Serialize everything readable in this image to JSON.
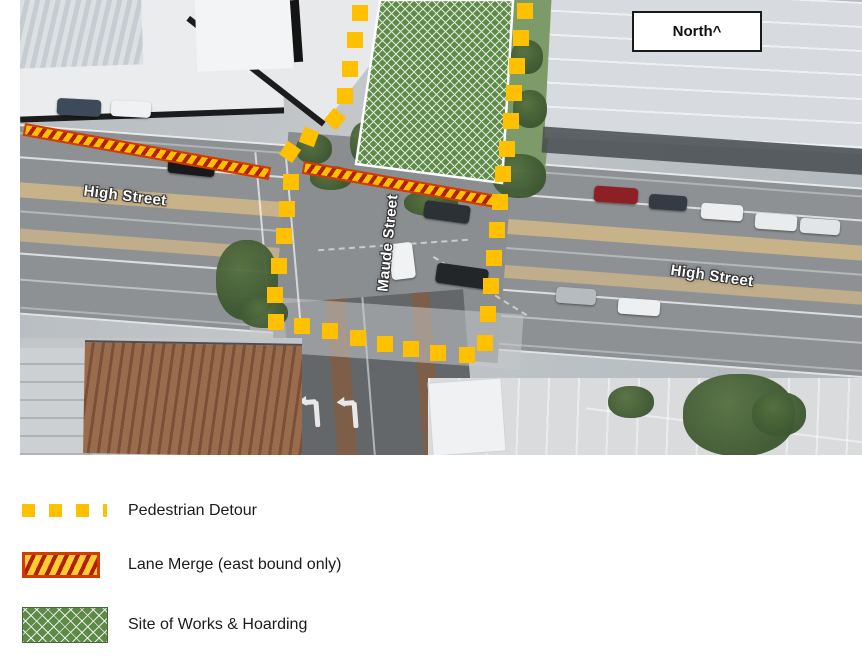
{
  "north_box": {
    "label": "North^"
  },
  "map": {
    "street_labels": [
      {
        "id": "high-street-west",
        "text": "High Street"
      },
      {
        "id": "maude-street",
        "text": "Maude Street"
      },
      {
        "id": "high-street-east",
        "text": "High Street"
      }
    ],
    "overlays": {
      "colors": {
        "detour_yellow": "#FFC000",
        "merge_stripe": "#B02000",
        "merge_border": "#D43A00",
        "works_green": "#5D8A47"
      },
      "works_polygon": "380,0 513,0 502,183 356,164",
      "merge_bars": [
        {
          "x": 25,
          "y": 123,
          "len": 250,
          "angle": 10.2,
          "th": 13
        },
        {
          "x": 304,
          "y": 161,
          "len": 196,
          "angle": 10.0,
          "th": 13
        }
      ],
      "detour_squares": [
        [
          352,
          5
        ],
        [
          347,
          32
        ],
        [
          342,
          61
        ],
        [
          337,
          88
        ],
        [
          327,
          111,
          40
        ],
        [
          301,
          129,
          20
        ],
        [
          282,
          144,
          35
        ],
        [
          283,
          174
        ],
        [
          279,
          201
        ],
        [
          276,
          228
        ],
        [
          271,
          258
        ],
        [
          267,
          287
        ],
        [
          268,
          314
        ],
        [
          294,
          318
        ],
        [
          322,
          323
        ],
        [
          350,
          330
        ],
        [
          377,
          336
        ],
        [
          403,
          341
        ],
        [
          430,
          345
        ],
        [
          459,
          347
        ],
        [
          477,
          335
        ],
        [
          480,
          306
        ],
        [
          483,
          278
        ],
        [
          486,
          250
        ],
        [
          489,
          222
        ],
        [
          492,
          194
        ],
        [
          495,
          166
        ],
        [
          499,
          141
        ],
        [
          503,
          113
        ],
        [
          506,
          85
        ],
        [
          509,
          58
        ],
        [
          513,
          30
        ],
        [
          517,
          3
        ]
      ]
    },
    "decor": {
      "trees": [
        [
          216,
          240,
          62,
          80
        ],
        [
          240,
          298,
          48,
          30
        ],
        [
          296,
          134,
          36,
          30
        ],
        [
          350,
          122,
          30,
          42
        ],
        [
          310,
          166,
          42,
          24
        ],
        [
          404,
          190,
          54,
          26
        ],
        [
          492,
          154,
          54,
          44
        ],
        [
          513,
          90,
          34,
          38
        ],
        [
          511,
          40,
          32,
          34
        ],
        [
          683,
          374,
          112,
          82
        ],
        [
          608,
          386,
          46,
          32
        ],
        [
          752,
          392,
          54,
          44
        ]
      ],
      "cars": [
        [
          57,
          99,
          44,
          17,
          "#3d4a59",
          3
        ],
        [
          111,
          101,
          40,
          16,
          "#eff1f3",
          3
        ],
        [
          168,
          157,
          47,
          18,
          "#17191b",
          6
        ],
        [
          390,
          243,
          24,
          36,
          "#f0f2f3",
          -7
        ],
        [
          436,
          266,
          52,
          20,
          "#222629",
          8
        ],
        [
          424,
          203,
          46,
          18,
          "#2c3136",
          8
        ],
        [
          594,
          187,
          44,
          16,
          "#8e2025",
          4
        ],
        [
          649,
          195,
          38,
          15,
          "#343b42",
          4
        ],
        [
          701,
          204,
          42,
          16,
          "#eceef0",
          4
        ],
        [
          755,
          214,
          42,
          16,
          "#e9eced",
          4
        ],
        [
          556,
          288,
          40,
          16,
          "#b6bbbf",
          4
        ],
        [
          618,
          299,
          42,
          16,
          "#edeff0",
          4
        ],
        [
          800,
          219,
          40,
          15,
          "#e2e4e6",
          4
        ]
      ]
    }
  },
  "legend": {
    "items": [
      {
        "key": "pedestrian-detour",
        "label": "Pedestrian Detour"
      },
      {
        "key": "lane-merge",
        "label": "Lane Merge (east bound only)"
      },
      {
        "key": "site-works",
        "label": "Site of Works & Hoarding"
      }
    ]
  }
}
